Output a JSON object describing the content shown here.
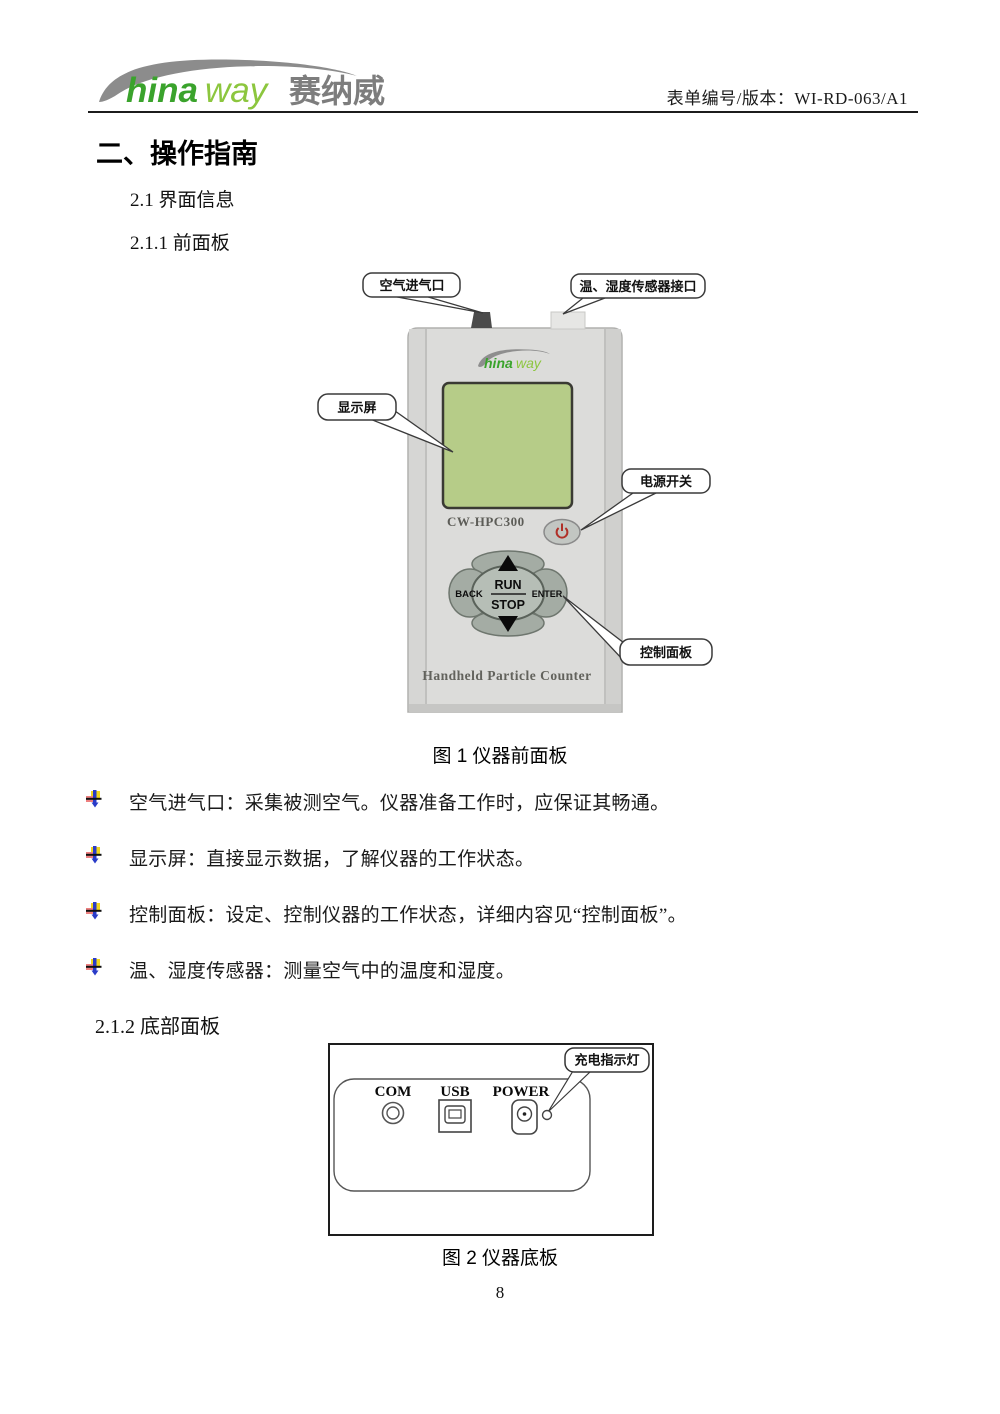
{
  "header": {
    "logo": {
      "hina": "hina",
      "way": "way",
      "cn": "赛纳威"
    },
    "doc_number": "表单编号/版本：WI-RD-063/A1"
  },
  "headings": {
    "main": "二、操作指南",
    "s21": "2.1 界面信息",
    "s211": "2.1.1 前面板",
    "s212": "2.1.2 底部面板"
  },
  "figure1": {
    "caption": "图 1  仪器前面板",
    "callouts": {
      "air_inlet": "空气进气口",
      "sensor_port": "温、湿度传感器接口",
      "display": "显示屏",
      "power_switch": "电源开关",
      "control_panel": "控制面板"
    },
    "device": {
      "model": "CW-HPC300",
      "keypad": {
        "back": "BACK",
        "run": "RUN",
        "stop": "STOP",
        "enter": "ENTER"
      },
      "footer": "Handheld Particle Counter"
    }
  },
  "bullets": [
    {
      "text": "空气进气口：采集被测空气。仪器准备工作时，应保证其畅通。"
    },
    {
      "text": "显示屏：直接显示数据，了解仪器的工作状态。"
    },
    {
      "text": "控制面板：设定、控制仪器的工作状态，详细内容见“控制面板”。"
    },
    {
      "text": "温、湿度传感器：测量空气中的温度和湿度。"
    }
  ],
  "figure2": {
    "caption": "图 2  仪器底板",
    "callout_led": "充电指示灯",
    "ports": {
      "com": "COM",
      "usb": "USB",
      "power": "POWER"
    }
  },
  "page_number": "8",
  "colors": {
    "logo_green_dark": "#3aa32c",
    "logo_green_light": "#8cc63e",
    "logo_gray": "#7d7d7d",
    "screen_green": "#b6cc88",
    "device_body": "#dcdcda",
    "power_red": "#b03028"
  }
}
